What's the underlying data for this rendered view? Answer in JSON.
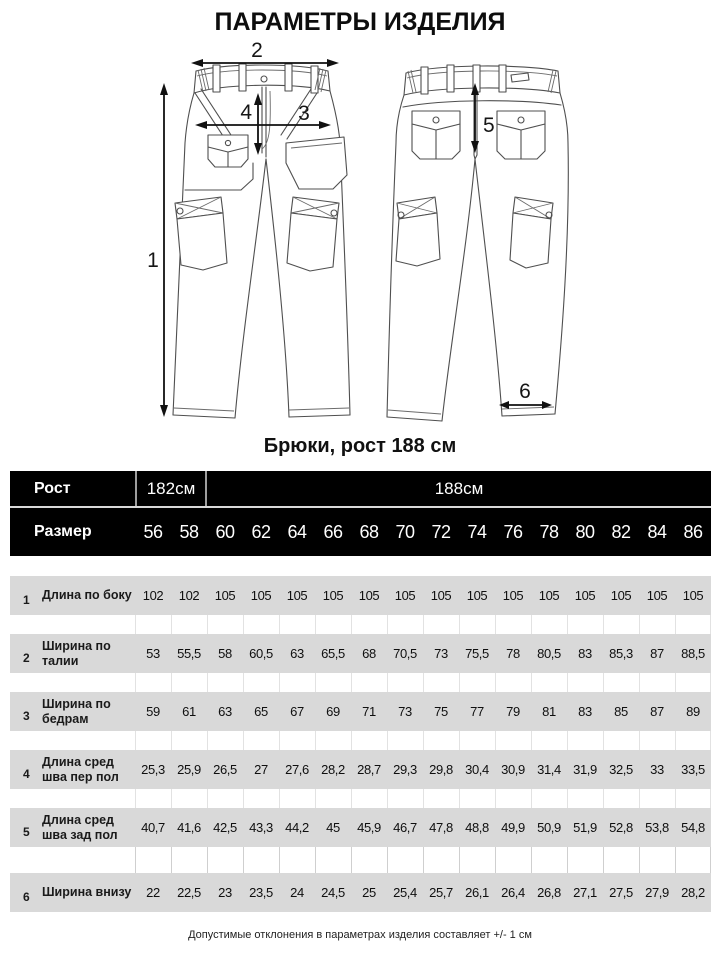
{
  "title": "ПАРАМЕТРЫ ИЗДЕЛИЯ",
  "diagram": {
    "caption": "Брюки, рост 188 см",
    "annotations": [
      "1",
      "2",
      "3",
      "4",
      "5",
      "6"
    ]
  },
  "table": {
    "height_label": "Рост",
    "height_groups": [
      {
        "label": "182см",
        "span": 2
      },
      {
        "label": "188см",
        "span": 14
      }
    ],
    "size_label": "Размер",
    "sizes": [
      "56",
      "58",
      "60",
      "62",
      "64",
      "66",
      "68",
      "70",
      "72",
      "74",
      "76",
      "78",
      "80",
      "82",
      "84",
      "86"
    ],
    "rows": [
      {
        "num": "1",
        "label": "Длина по боку",
        "values": [
          "102",
          "102",
          "105",
          "105",
          "105",
          "105",
          "105",
          "105",
          "105",
          "105",
          "105",
          "105",
          "105",
          "105",
          "105",
          "105"
        ]
      },
      {
        "num": "2",
        "label": "Ширина по талии",
        "values": [
          "53",
          "55,5",
          "58",
          "60,5",
          "63",
          "65,5",
          "68",
          "70,5",
          "73",
          "75,5",
          "78",
          "80,5",
          "83",
          "85,3",
          "87",
          "88,5"
        ]
      },
      {
        "num": "3",
        "label": "Ширина по бедрам",
        "values": [
          "59",
          "61",
          "63",
          "65",
          "67",
          "69",
          "71",
          "73",
          "75",
          "77",
          "79",
          "81",
          "83",
          "85",
          "87",
          "89"
        ]
      },
      {
        "num": "4",
        "label": "Длина сред шва пер пол",
        "values": [
          "25,3",
          "25,9",
          "26,5",
          "27",
          "27,6",
          "28,2",
          "28,7",
          "29,3",
          "29,8",
          "30,4",
          "30,9",
          "31,4",
          "31,9",
          "32,5",
          "33",
          "33,5"
        ]
      },
      {
        "num": "5",
        "label": "Длина сред шва зад пол",
        "values": [
          "40,7",
          "41,6",
          "42,5",
          "43,3",
          "44,2",
          "45",
          "45,9",
          "46,7",
          "47,8",
          "48,8",
          "49,9",
          "50,9",
          "51,9",
          "52,8",
          "53,8",
          "54,8"
        ]
      },
      {
        "num": "6",
        "label": "Ширина внизу",
        "values": [
          "22",
          "22,5",
          "23",
          "23,5",
          "24",
          "24,5",
          "25",
          "25,4",
          "25,7",
          "26,1",
          "26,4",
          "26,8",
          "27,1",
          "27,5",
          "27,9",
          "28,2"
        ]
      }
    ]
  },
  "footer_note": "Допустимые отклонения в параметрах изделия составляет +/- 1 см",
  "colors": {
    "header_bg": "#000000",
    "header_text": "#ffffff",
    "row_bg": "#d9d9d9",
    "drawing_line": "#4f4f4f",
    "arrow": "#111111"
  }
}
